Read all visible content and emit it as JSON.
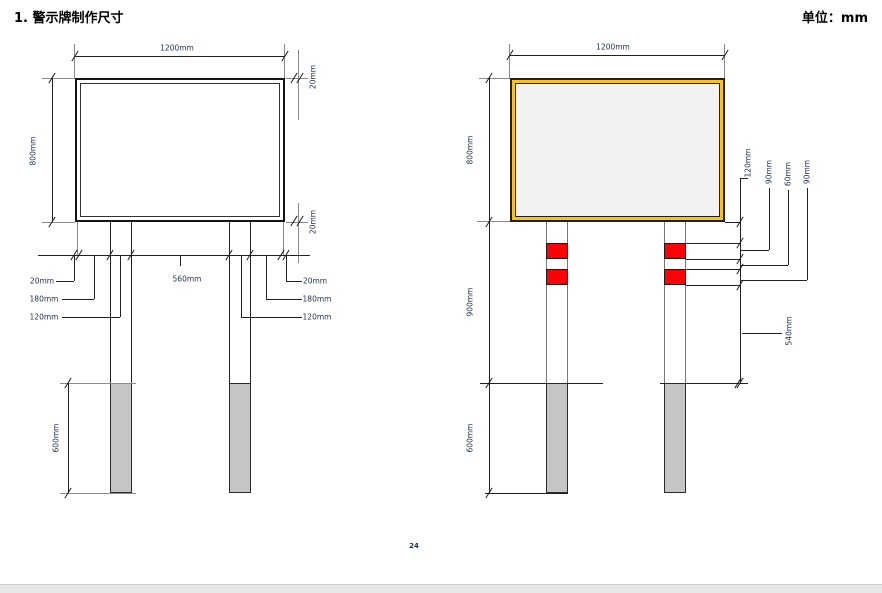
{
  "header": {
    "title": "1. 警示牌制作尺寸",
    "unit": "单位：mm"
  },
  "footer": {
    "page_number": "24"
  },
  "left": {
    "width": "1200mm",
    "height": "800mm",
    "border_top": "20mm",
    "border_bottom": "20mm",
    "edge_l": "20mm",
    "offset_l": "180mm",
    "postw_l": "120mm",
    "spacing": "560mm",
    "edge_r": "20mm",
    "offset_r": "180mm",
    "postw_r": "120mm",
    "depth": "600mm"
  },
  "right": {
    "width": "1200mm",
    "height": "800mm",
    "band_offset": "120mm",
    "band1": "90mm",
    "gap": "60mm",
    "band2": "90mm",
    "above_ground": "900mm",
    "to_ground": "540mm",
    "depth": "600mm"
  },
  "colors": {
    "sign_border_yellow": "#fdc40d",
    "sign_face_gray": "#f2f2f2",
    "band_red": "#fb0207",
    "buried_post_gray": "#c5c5c5",
    "line": "#222222",
    "dim_text": "#233250"
  }
}
